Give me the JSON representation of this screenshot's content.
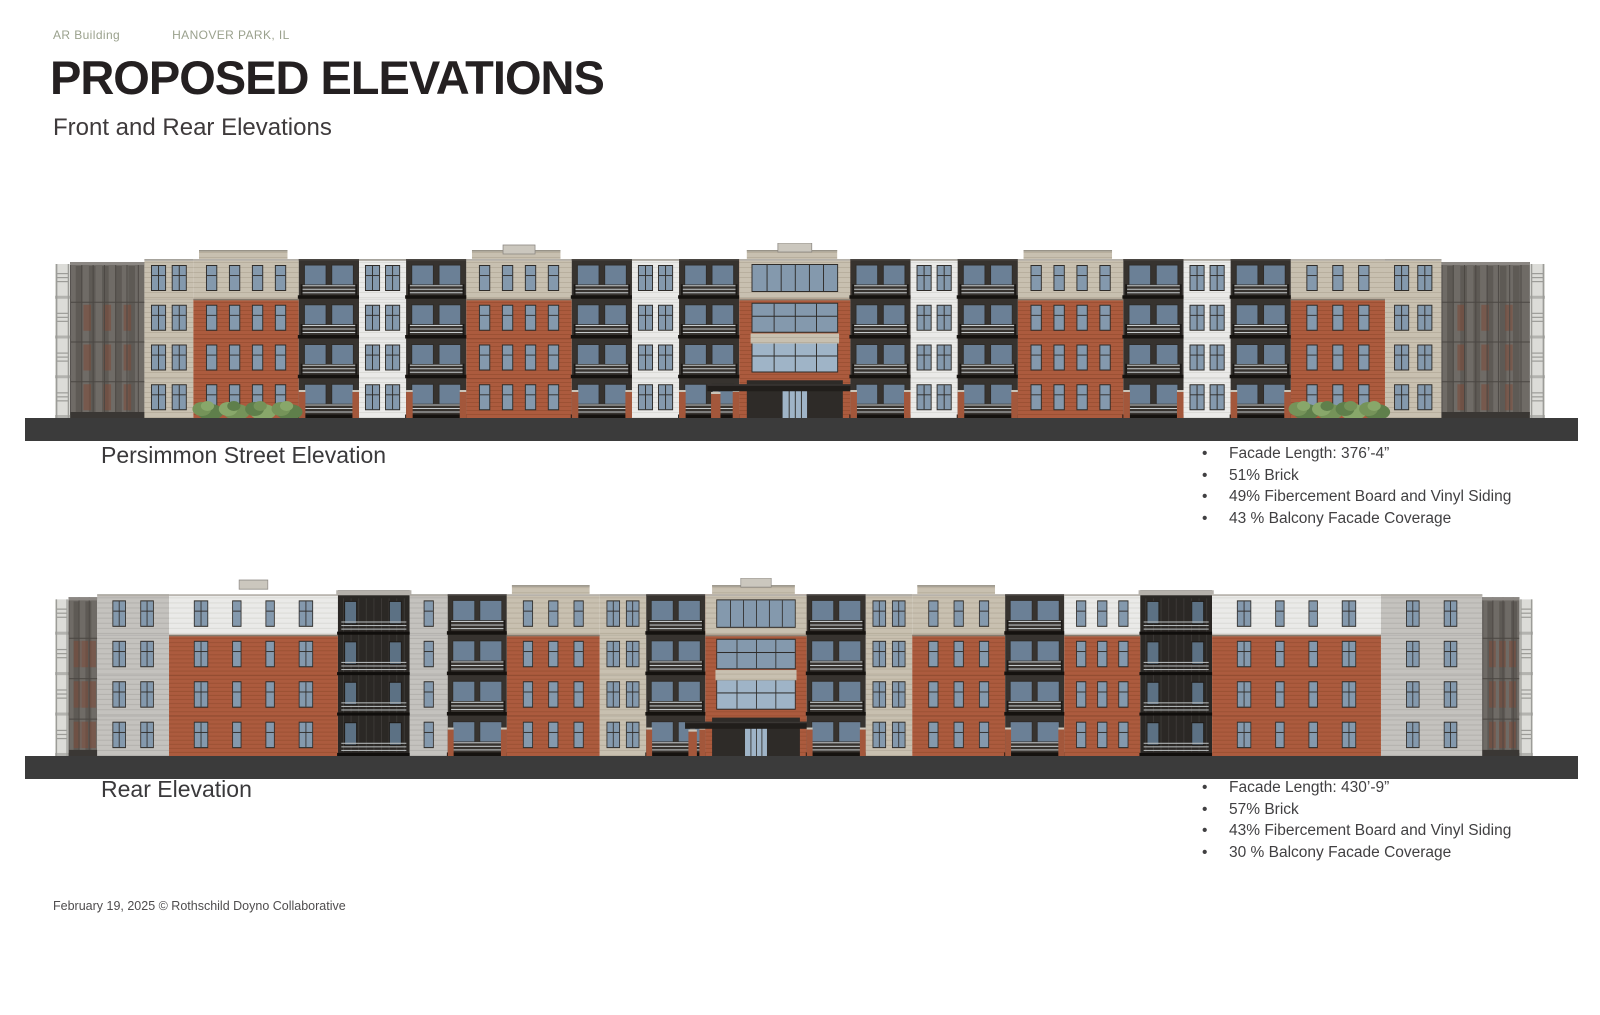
{
  "header": {
    "project": "AR Building",
    "location": "HANOVER PARK, IL",
    "title": "PROPOSED ELEVATIONS",
    "subtitle": "Front and Rear Elevations"
  },
  "footer": {
    "credit": "February 19, 2025 © Rothschild Doyno Collaborative"
  },
  "colors": {
    "brick": "#AC5B3E",
    "brick_line": "#9C5134",
    "brick_pier": "#A3573B",
    "tan": "#C8C0B0",
    "tan_line": "#B8AF9E",
    "white_siding": "#EAEAE8",
    "white_line": "#DBDBD7",
    "gray_panel": "#C4C2BE",
    "gray_line": "#B3B1AD",
    "dark_recess": "#37332F",
    "dark_tower": "#2B2825",
    "frame": "#2F2C29",
    "glass": "#8499AD",
    "glass_door": "#6B8096",
    "entry_glass": "#9FB4C7",
    "railing": "#C6CACB",
    "slab": "#15120F",
    "ground": "#3B3B3B",
    "canopy": "#211E1B",
    "post": "#8F8B85",
    "cap": "#989388",
    "cornice": "#B5B1AA",
    "trim": "#8E8578",
    "roof_unit": "#CBC7BE",
    "roof_unit_edge": "#8B8782",
    "wing_body": "#6F6B66",
    "wing_dark": "#5E5A55",
    "wing_grid": "#4B4743",
    "wing_strip": "#DCDCD8",
    "wing_rail": "#9C9C98",
    "wing_patch": "#7E4A38",
    "bush_dark": "#5F7F4B",
    "bush_mid": "#759359",
    "bush_light": "#88A76A",
    "accent_text": "#9AA18D"
  },
  "elevations": [
    {
      "label": "Persimmon Street Elevation",
      "stats": [
        "Facade Length: 376’-4”",
        "51% Brick",
        "49% Fibercement Board and Vinyl Siding",
        "43 % Balcony Facade Coverage"
      ],
      "bays": [
        {
          "t": "wing",
          "w": 95
        },
        {
          "t": "sided",
          "m": "tan",
          "w": 52,
          "cols": 2
        },
        {
          "t": "brick",
          "top": "tan",
          "w": 112,
          "cols": 4,
          "parapet": true,
          "bush": true
        },
        {
          "t": "balc",
          "w": 64
        },
        {
          "t": "sided",
          "m": "white",
          "w": 50,
          "cols": 2
        },
        {
          "t": "balc",
          "w": 64
        },
        {
          "t": "brick",
          "top": "tan",
          "w": 112,
          "cols": 4,
          "parapet": true,
          "roofUnit": true
        },
        {
          "t": "balc",
          "w": 64
        },
        {
          "t": "sided",
          "m": "white",
          "w": 50,
          "cols": 2
        },
        {
          "t": "balc",
          "w": 64
        },
        {
          "t": "center",
          "w": 118,
          "roofUnit": true
        },
        {
          "t": "balc",
          "w": 64
        },
        {
          "t": "sided",
          "m": "white",
          "w": 50,
          "cols": 2
        },
        {
          "t": "balc",
          "w": 64
        },
        {
          "t": "brick",
          "top": "tan",
          "w": 112,
          "cols": 4,
          "parapet": true
        },
        {
          "t": "balc",
          "w": 64
        },
        {
          "t": "sided",
          "m": "white",
          "w": 50,
          "cols": 2
        },
        {
          "t": "balc",
          "w": 64
        },
        {
          "t": "brick",
          "top": "tan",
          "w": 100,
          "cols": 3,
          "bush": true
        },
        {
          "t": "sided",
          "m": "tan",
          "w": 60,
          "cols": 2
        },
        {
          "t": "wing",
          "w": 110,
          "mirror": true
        }
      ]
    },
    {
      "label": "Rear Elevation",
      "stats": [
        "Facade Length: 430’-9”",
        "57% Brick",
        "43% Fibercement Board and Vinyl Siding",
        "30 % Balcony Facade Coverage"
      ],
      "bays": [
        {
          "t": "wing",
          "w": 50
        },
        {
          "t": "sided",
          "m": "gray",
          "w": 85,
          "cols": 2
        },
        {
          "t": "brick",
          "top": "white",
          "w": 200,
          "cols": 4,
          "mixWin": true,
          "roofUnit": true
        },
        {
          "t": "tower",
          "w": 85
        },
        {
          "t": "sided",
          "m": "gray",
          "w": 45,
          "cols": 1
        },
        {
          "t": "balc",
          "w": 70
        },
        {
          "t": "brick",
          "top": "tan",
          "w": 110,
          "cols": 3,
          "parapet": true
        },
        {
          "t": "sided",
          "m": "tan",
          "w": 55,
          "cols": 2
        },
        {
          "t": "balc",
          "w": 70
        },
        {
          "t": "center",
          "w": 120,
          "small": true,
          "roofUnit": true
        },
        {
          "t": "balc",
          "w": 70
        },
        {
          "t": "sided",
          "m": "tan",
          "w": 55,
          "cols": 2
        },
        {
          "t": "brick",
          "top": "tan",
          "w": 110,
          "cols": 3,
          "parapet": true
        },
        {
          "t": "balc",
          "w": 70
        },
        {
          "t": "brick",
          "top": "white",
          "w": 90,
          "cols": 3
        },
        {
          "t": "tower",
          "w": 85
        },
        {
          "t": "brick",
          "top": "white",
          "w": 200,
          "cols": 4,
          "mixWin": true
        },
        {
          "t": "sided",
          "m": "gray",
          "w": 120,
          "cols": 2,
          "roofUnit": true
        },
        {
          "t": "wing",
          "w": 60,
          "mirror": true
        }
      ]
    }
  ]
}
